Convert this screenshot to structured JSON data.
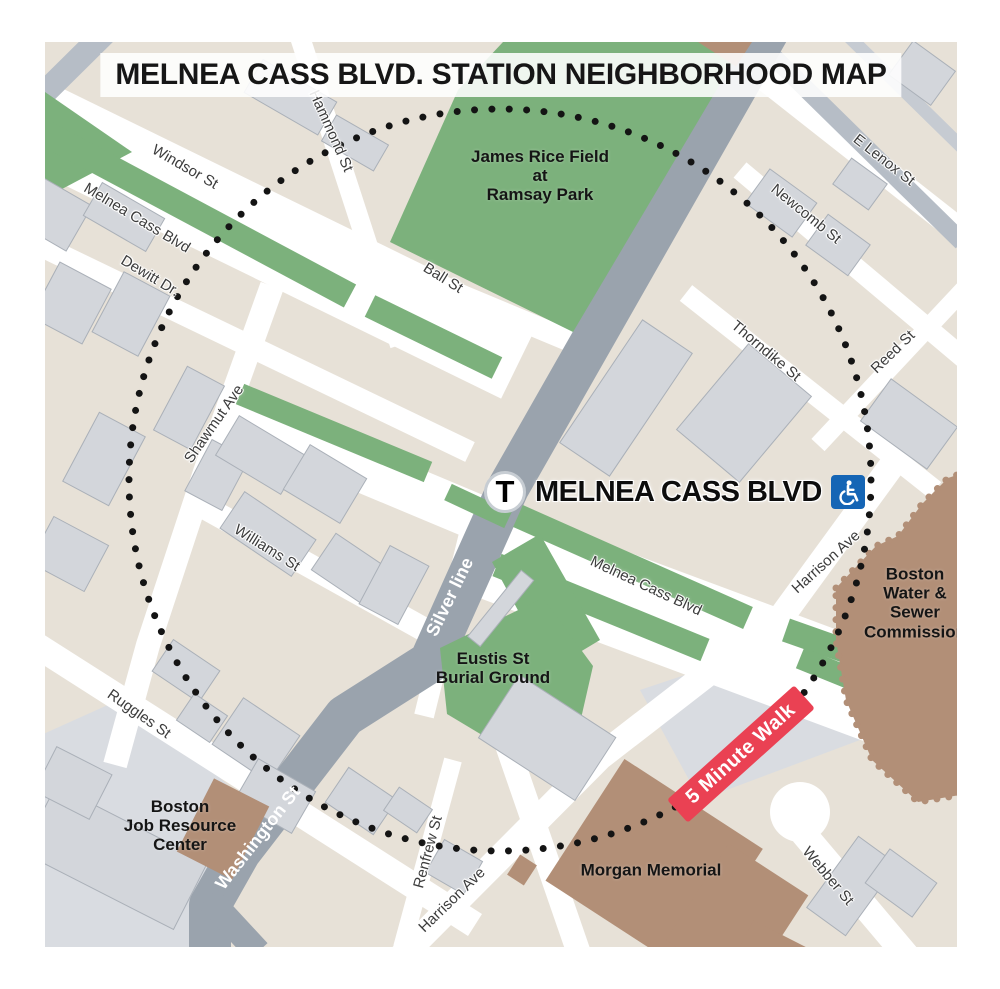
{
  "title": "MELNEA CASS BLVD. STATION NEIGHBORHOOD MAP",
  "station": {
    "logo_letter": "T",
    "name": "MELNEA CASS BLVD",
    "accessible_icon": "wheelchair-icon"
  },
  "walk_badge": {
    "label": "5 Minute Walk"
  },
  "streets": {
    "windsor": "Windsor St",
    "melnea_cass_nw": "Melnea Cass Blvd",
    "dewitt": "Dewitt Dr.",
    "hammond": "Hammond St",
    "ball": "Ball St",
    "e_lenox": "E Lenox St",
    "newcomb": "Newcomb St",
    "thorndike": "Thorndike St",
    "reed": "Reed St",
    "shawmut": "Shawmut Ave",
    "williams": "Williams St",
    "silver_line": "Silver line",
    "melnea_cass_se": "Melnea Cass Blvd",
    "harrison_ne": "Harrison Ave",
    "ruggles": "Ruggles St",
    "washington": "Washington St",
    "renfrew": "Renfrew St",
    "harrison_sw": "Harrison Ave",
    "webber": "Webber St"
  },
  "places": {
    "ramsay_park": "James Rice Field\nat\nRamsay Park",
    "eustis": "Eustis St\nBurial Ground",
    "water_sewer": "Boston\nWater &\nSewer\nCommission",
    "job_center": "Boston\nJob Resource\nCenter",
    "morgan": "Morgan Memorial"
  },
  "colors": {
    "base_beige": "#E7E1D7",
    "block_gray": "#D9DCE1",
    "road_gray": "#9AA3AD",
    "road_gray_light": "#B6BDC6",
    "building_gray": "#D3D6DB",
    "park_green": "#7CB17C",
    "brown": "#B28F77",
    "red_badge": "#EA4153",
    "blue_access": "#1565B5",
    "dot_black": "#141414"
  }
}
